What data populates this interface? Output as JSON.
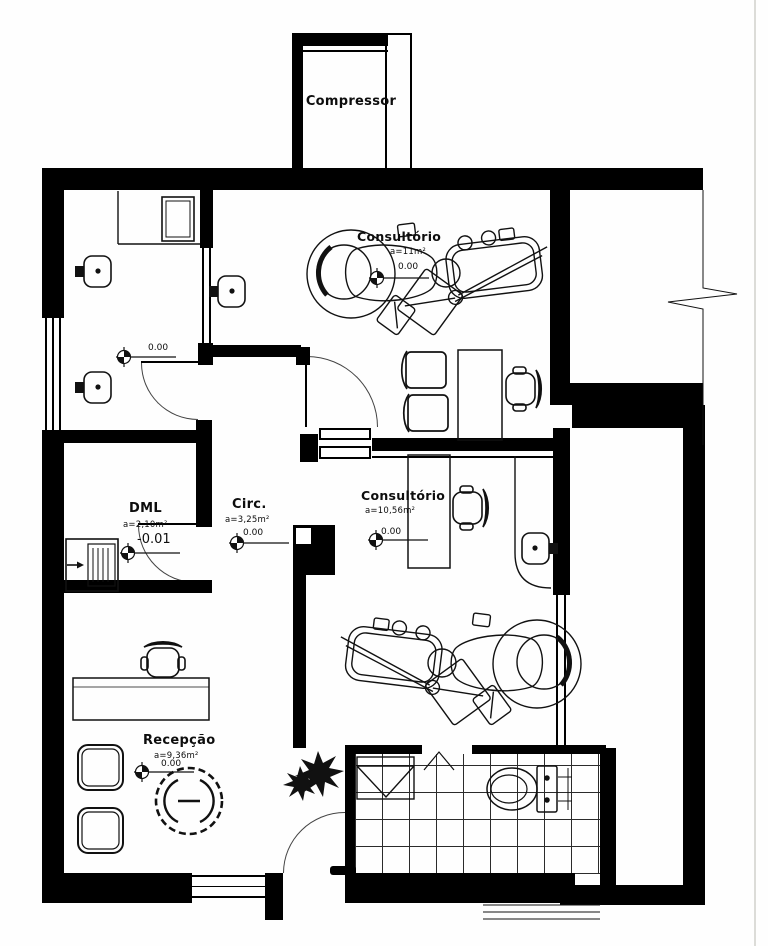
{
  "drawing": {
    "type": "architectural-floor-plan",
    "discipline": "dental-clinic-layout",
    "line_color": "#000000",
    "paper_color": "#fefefe"
  },
  "rooms": {
    "compressor": {
      "label": "Compressor"
    },
    "consultorio1": {
      "label": "Consultório",
      "area": "a=11m²",
      "level": "0.00"
    },
    "consultorio2": {
      "label": "Consultório",
      "area": "a=10,56m²",
      "level": "0.00"
    },
    "dml": {
      "label": "DML",
      "area": "a=2,10m²",
      "level": "-0.01"
    },
    "circ": {
      "label": "Circ.",
      "area": "a=3,25m²",
      "level": "0.00"
    },
    "recepcao": {
      "label": "Recepção",
      "area": "a=9,36m²",
      "level": "0.00"
    },
    "servico": {
      "level": "0.00"
    }
  },
  "symbols": {
    "dental_unit": "dental-treatment-chair-unit",
    "toilet": "toilet",
    "shower": "shower-tray",
    "round_table": "round-table-with-chairs",
    "plant": "potted-plant",
    "sink": "wall-hung-sink",
    "utility_sink": "utility-tank-sink",
    "office_chair": "office-chair",
    "armchair": "waiting-armchair",
    "level_marker": "floor-level-benchmark",
    "break_line": "wall-break-symbol"
  }
}
